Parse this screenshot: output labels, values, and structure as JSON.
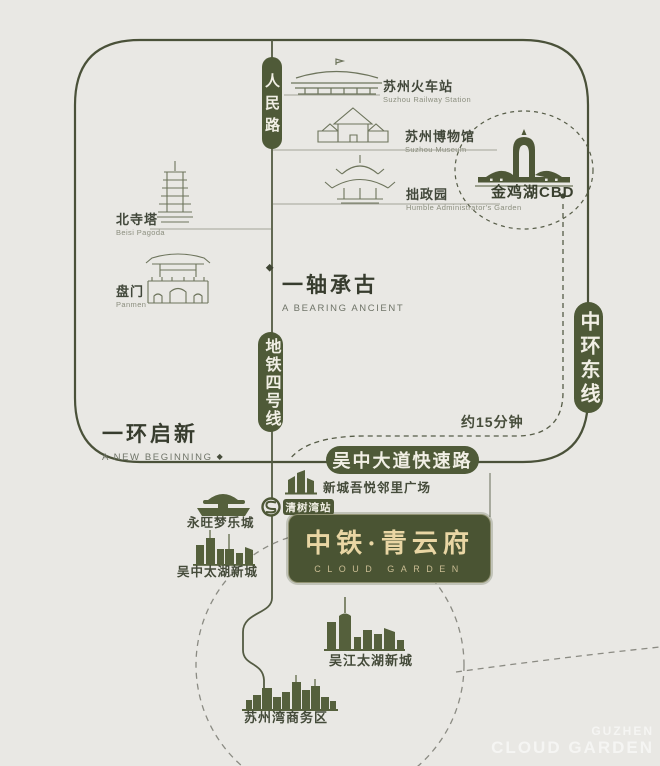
{
  "map": {
    "roads": {
      "renmin_road": "人民路",
      "metro_line_4": "地铁四号线",
      "middle_ring_east": "中环东线",
      "wuzhong_expressway": "吴中大道快速路"
    },
    "landmarks": {
      "railway_station": {
        "zh": "苏州火车站",
        "en": "Suzhou Railway Station"
      },
      "museum": {
        "zh": "苏州博物馆",
        "en": "Suzhou Museum"
      },
      "humble_garden": {
        "zh": "拙政园",
        "en": "Humble Administrator's Garden"
      },
      "beisi_pagoda": {
        "zh": "北寺塔",
        "en": "Beisi Pagoda"
      },
      "panmen": {
        "zh": "盘门",
        "en": "Panmen"
      }
    },
    "slogans": {
      "axis": {
        "zh": "一轴承古",
        "en": "A BEARING ANCIENT"
      },
      "ring": {
        "zh": "一环启新",
        "en": "A NEW BEGINNING"
      }
    },
    "cbd_label": "金鸡湖CBD",
    "travel_time": "约15分钟",
    "metro_station": "清树湾站",
    "pois": {
      "wuyue_plaza": "新城吾悦邻里广场",
      "aeon_mall": "永旺梦乐城",
      "wuzhong_taihu": "吴中太湖新城",
      "wujiang_taihu": "吴江太湖新城",
      "suzhou_bay": "苏州湾商务区"
    },
    "project": {
      "name": "中铁·青云府",
      "en": "CLOUD GARDEN"
    }
  },
  "markers": {
    "diamond": "◆"
  },
  "watermark": {
    "line1": "GUZHEN",
    "line2": "CLOUD GARDEN"
  },
  "colors": {
    "background": "#e9e8e4",
    "road": "#4a5139",
    "pill_green": "#4f5a38",
    "project_box_green": "#4a5433",
    "project_gold": "#e9d6a4",
    "icon_fill": "#55603c",
    "dashed_gray": "#8b8b83"
  }
}
